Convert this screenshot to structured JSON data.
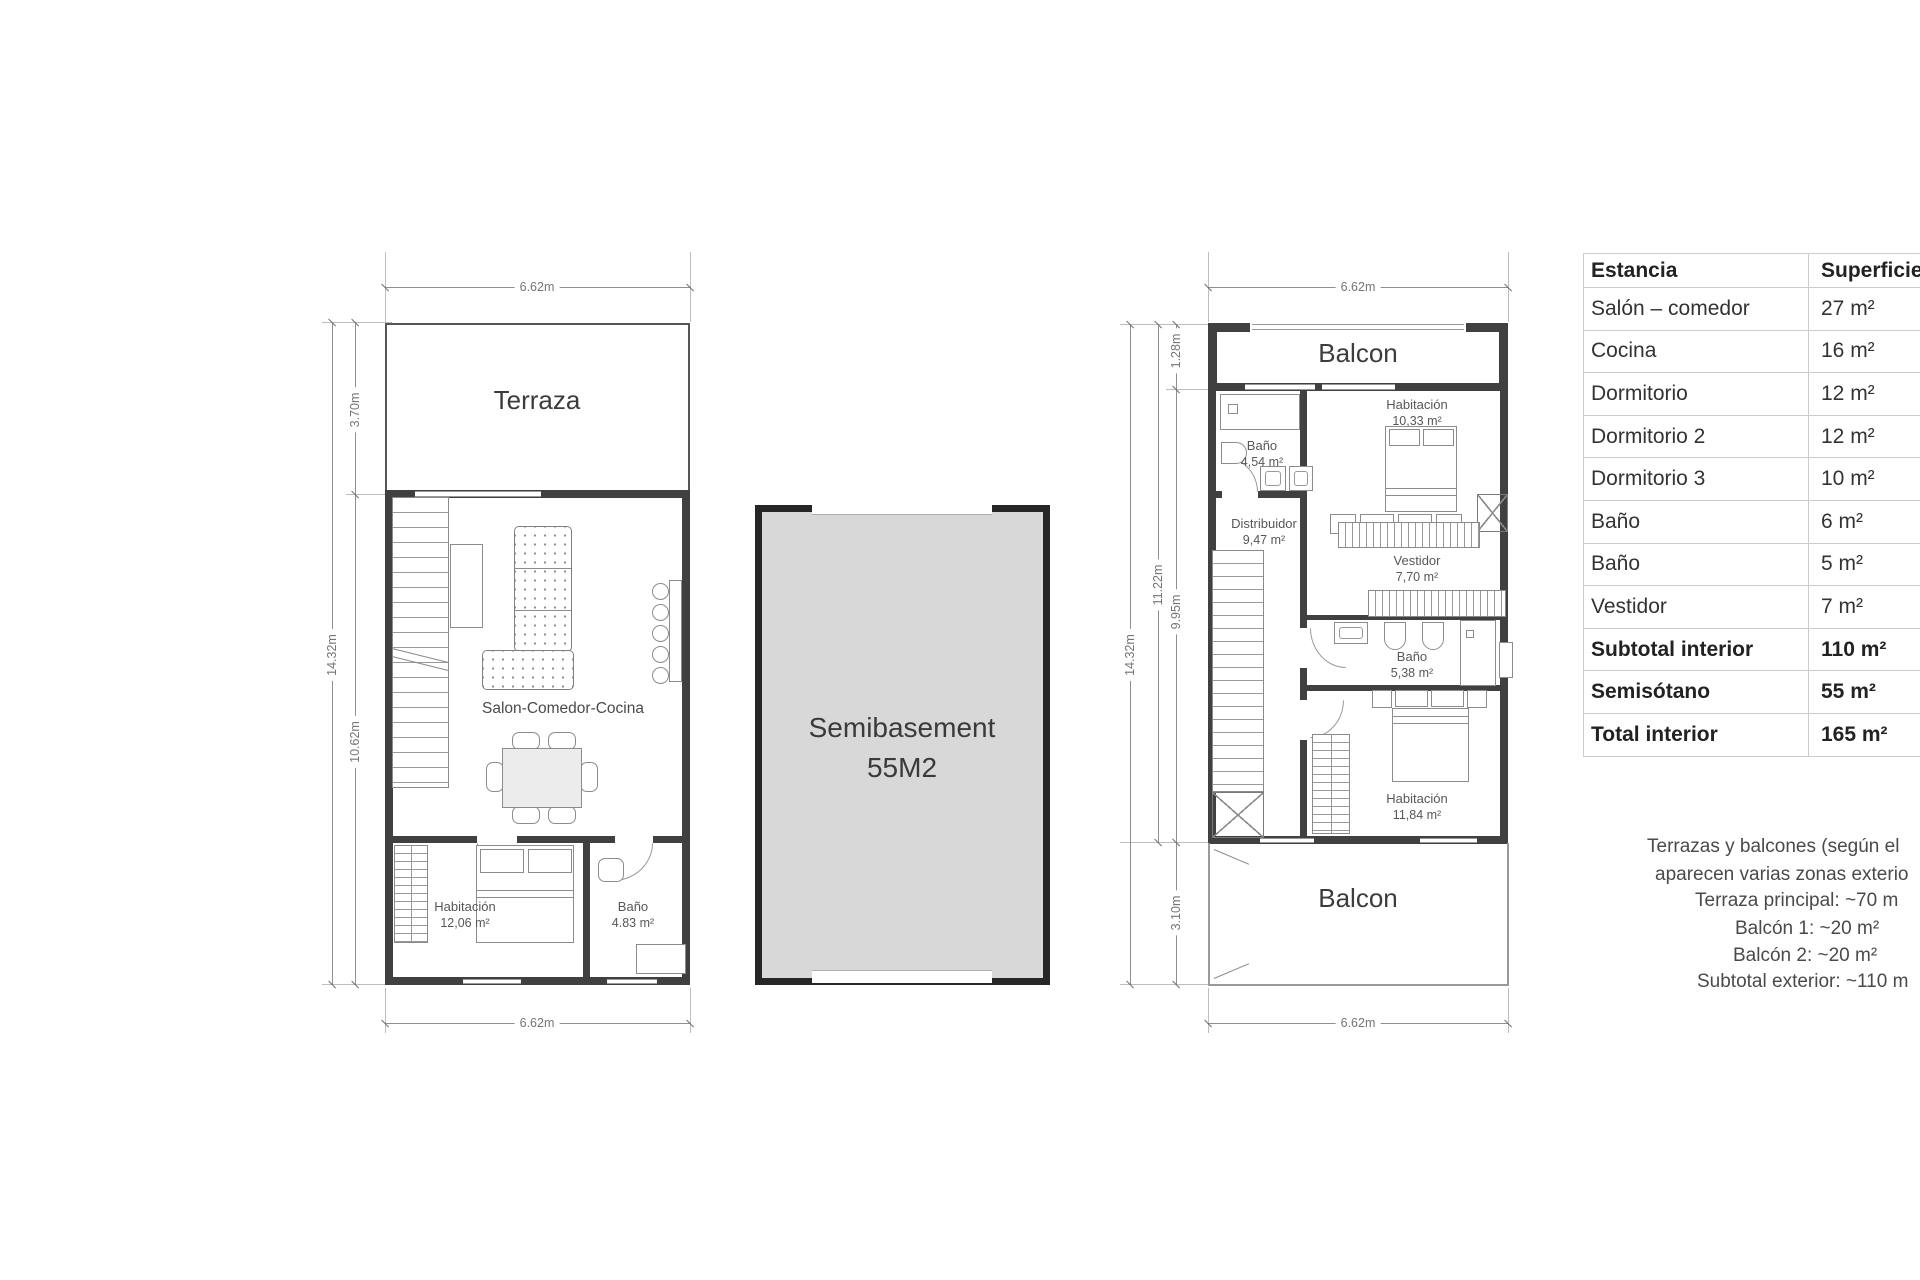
{
  "ground_floor": {
    "terrace_label": "Terraza",
    "living_label": "Salon-Comedor-Cocina",
    "bedroom_name": "Habitación",
    "bedroom_area": "12,06 m²",
    "bath_name": "Baño",
    "bath_area": "4.83 m²",
    "dim_width_top": "6.62m",
    "dim_width_bottom": "6.62m",
    "dim_height_total": "14.32m",
    "dim_terrace": "3.70m",
    "dim_interior": "10.62m"
  },
  "basement": {
    "title": "Semibasement",
    "area": "55M2"
  },
  "upper_floor": {
    "balcony_top_label": "Balcon",
    "balcony_bottom_label": "Balcon",
    "bedroom1_name": "Habitación",
    "bedroom1_area": "10,33 m²",
    "bath1_name": "Baño",
    "bath1_area": "4,54 m²",
    "hall_name": "Distribuidor",
    "hall_area": "9,47 m²",
    "dressing_name": "Vestidor",
    "dressing_area": "7,70 m²",
    "bath2_name": "Baño",
    "bath2_area": "5,38 m²",
    "bedroom2_name": "Habitación",
    "bedroom2_area": "11,84 m²",
    "dim_width_top": "6.62m",
    "dim_width_bottom": "6.62m",
    "dim_height_total": "14.32m",
    "dim_height_upper": "11.22m",
    "dim_height_interior": "9.95m",
    "dim_balcony_top": "1.28m",
    "dim_balcony_bottom": "3.10m"
  },
  "area_table": {
    "header_room": "Estancia",
    "header_area": "Superficie",
    "rows": [
      {
        "name": "Salón – comedor",
        "area": "27 m²"
      },
      {
        "name": "Cocina",
        "area": "16 m²"
      },
      {
        "name": "Dormitorio",
        "area": "12 m²"
      },
      {
        "name": "Dormitorio 2",
        "area": "12 m²"
      },
      {
        "name": "Dormitorio 3",
        "area": "10 m²"
      },
      {
        "name": "Baño",
        "area": "6 m²"
      },
      {
        "name": "Baño",
        "area": "5 m²"
      },
      {
        "name": "Vestidor",
        "area": "7 m²"
      },
      {
        "name": "Subtotal interior",
        "area": "110 m²"
      },
      {
        "name": "Semisótano",
        "area": "55 m²"
      },
      {
        "name": "Total interior",
        "area": "165 m²"
      }
    ]
  },
  "notes": {
    "lines": [
      "Terrazas y balcones (según el",
      "aparecen varias zonas exterio",
      "Terraza principal: ~70 m",
      "Balcón 1: ~20 m²",
      "Balcón 2: ~20 m²",
      "Subtotal exterior: ~110 m"
    ]
  }
}
